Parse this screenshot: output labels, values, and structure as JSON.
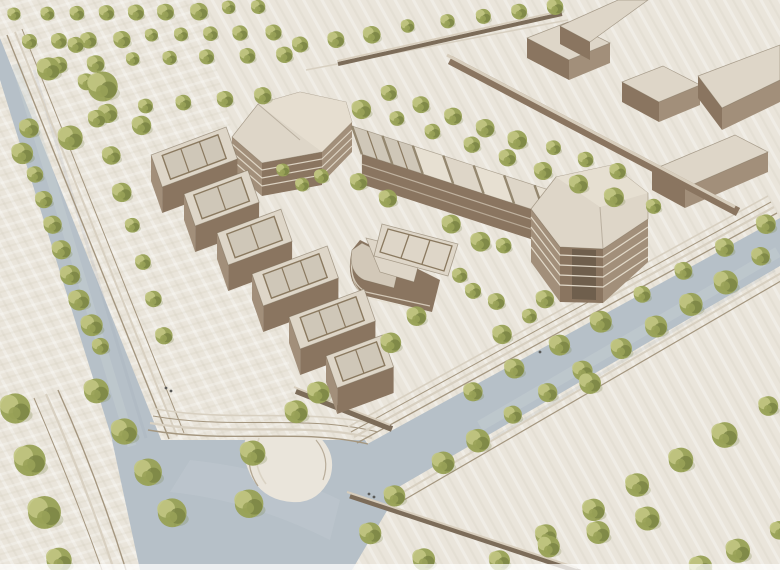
{
  "scene": {
    "type": "architectural-site-model",
    "view": "aerial-axonometric-photo",
    "description": "Aerial view of a cream-toned architectural massing model: a campus of timber-colored buildings around a courtyard plaza, bounded by blue-grey streets with stepped curbs and rows of small green model trees; simple context blocks sit at the top right."
  },
  "palette": {
    "ground": "#eae5db",
    "grainDark": "#c9bfae",
    "grainLight": "#ffffff",
    "road": "#b6c0c8",
    "roadLight": "#ccd2d6",
    "roadDark": "#9aa6b0",
    "stepLine": "#d8d0c1",
    "stepShadow": "#a4967f",
    "roofLight": "#ded6c8",
    "roofFacet": "#e7e0d2",
    "roofMid": "#d2c8b8",
    "roofPit": "#cfc7b8",
    "frameLine": "#8a795f",
    "facade": "#a28f7a",
    "facadeDark": "#8a7560",
    "facadeDeep": "#6f5f4d",
    "slabLine": "#e5ddcd",
    "wallDark": "#7c6c59",
    "wallTop": "#d7cdbc",
    "treeLight": "#c2c783",
    "treeMid": "#99a258",
    "treeDark": "#798343",
    "trunk": "#463d31",
    "figure": "#5a5a58"
  },
  "geometry": {
    "leftBar": {
      "u": [
        0.94,
        -0.35
      ],
      "v": [
        0.33,
        0.94
      ],
      "width": 34,
      "height": 26,
      "modules": [
        {
          "p": [
            151,
            155
          ],
          "len": 80,
          "bays": 3
        },
        {
          "p": [
            184,
            194
          ],
          "len": 68,
          "bays": 2
        },
        {
          "p": [
            217,
            233
          ],
          "len": 68,
          "bays": 2
        },
        {
          "p": [
            252,
            274
          ],
          "len": 80,
          "bays": 3
        },
        {
          "p": [
            289,
            317
          ],
          "len": 80,
          "bays": 3
        },
        {
          "p": [
            326,
            356
          ],
          "len": 60,
          "bays": 2
        }
      ]
    },
    "sawtooth": {
      "start": [
        352,
        126
      ],
      "dir": [
        0.951,
        0.309
      ],
      "panelLen": 32,
      "count": 8,
      "widthDir": [
        0.33,
        0.94
      ],
      "width": 30,
      "facadeHeight": 30,
      "openPanels": [
        0,
        1
      ]
    }
  },
  "trees": {
    "rows": [
      {
        "name": "top-row-1",
        "from": [
          16,
          16
        ],
        "to": [
          258,
          8
        ],
        "count": 9,
        "r": 8
      },
      {
        "name": "top-row-2",
        "from": [
          30,
          42
        ],
        "to": [
          272,
          32
        ],
        "count": 9,
        "r": 8
      },
      {
        "name": "top-row-3",
        "from": [
          58,
          64
        ],
        "to": [
          284,
          54
        ],
        "count": 7,
        "r": 8
      },
      {
        "name": "top-mid-row",
        "from": [
          108,
          112
        ],
        "to": [
          262,
          96
        ],
        "count": 5,
        "r": 9
      },
      {
        "name": "top-center-row",
        "from": [
          300,
          44
        ],
        "to": [
          556,
          6
        ],
        "count": 8,
        "r": 8
      },
      {
        "name": "left-road-west-row",
        "from": [
          24,
          152
        ],
        "to": [
          100,
          348
        ],
        "count": 9,
        "r": 10
      },
      {
        "name": "left-road-east-row",
        "from": [
          76,
          46
        ],
        "to": [
          166,
          336
        ],
        "count": 9,
        "r": 9
      },
      {
        "name": "southwest-row-a",
        "from": [
          14,
          408
        ],
        "to": [
          60,
          562
        ],
        "count": 4,
        "r": 15
      },
      {
        "name": "southwest-row-b",
        "from": [
          98,
          392
        ],
        "to": [
          172,
          512
        ],
        "count": 4,
        "r": 14
      },
      {
        "name": "north-band-row-1",
        "from": [
          362,
          108
        ],
        "to": [
          652,
          208
        ],
        "count": 9,
        "r": 9
      },
      {
        "name": "north-band-row-2",
        "from": [
          388,
          94
        ],
        "to": [
          618,
          172
        ],
        "count": 8,
        "r": 9
      },
      {
        "name": "east-road-nw-row",
        "from": [
          474,
          392
        ],
        "to": [
          768,
          224
        ],
        "count": 8,
        "r": 10
      },
      {
        "name": "east-road-se-row",
        "from": [
          442,
          462
        ],
        "to": [
          762,
          258
        ],
        "count": 10,
        "r": 11
      },
      {
        "name": "southeast-plaza-row-1",
        "from": [
          548,
          536
        ],
        "to": [
          770,
          408
        ],
        "count": 6,
        "r": 12
      },
      {
        "name": "southeast-plaza-row-2",
        "from": [
          498,
          562
        ],
        "to": [
          648,
          518
        ],
        "count": 4,
        "r": 12
      },
      {
        "name": "bottom-right-corner-row",
        "from": [
          702,
          566
        ],
        "to": [
          778,
          532
        ],
        "count": 3,
        "r": 11
      }
    ],
    "singles": [
      [
        48,
        70,
        13
      ],
      [
        103,
        87,
        16
      ],
      [
        30,
        128,
        10
      ],
      [
        72,
        137,
        12
      ],
      [
        140,
        124,
        9
      ],
      [
        282,
        172,
        8
      ],
      [
        302,
        186,
        8
      ],
      [
        322,
        177,
        8
      ],
      [
        360,
        182,
        9
      ],
      [
        390,
        198,
        9
      ],
      [
        450,
        223,
        9
      ],
      [
        480,
        240,
        9
      ],
      [
        460,
        277,
        9
      ],
      [
        474,
        292,
        9
      ],
      [
        498,
        302,
        9
      ],
      [
        415,
        316,
        10
      ],
      [
        390,
        342,
        10
      ],
      [
        502,
        333,
        9
      ],
      [
        530,
        318,
        9
      ],
      [
        505,
        247,
        9
      ],
      [
        547,
        300,
        10
      ],
      [
        295,
        412,
        12
      ],
      [
        318,
        392,
        11
      ],
      [
        253,
        452,
        12
      ],
      [
        250,
        502,
        13
      ],
      [
        372,
        535,
        13
      ],
      [
        393,
        497,
        12
      ],
      [
        423,
        560,
        12
      ],
      [
        590,
        383,
        11
      ]
    ]
  },
  "figures": [
    [
      166,
      388
    ],
    [
      171,
      391
    ],
    [
      369,
      494
    ],
    [
      374,
      497
    ],
    [
      540,
      352
    ]
  ]
}
